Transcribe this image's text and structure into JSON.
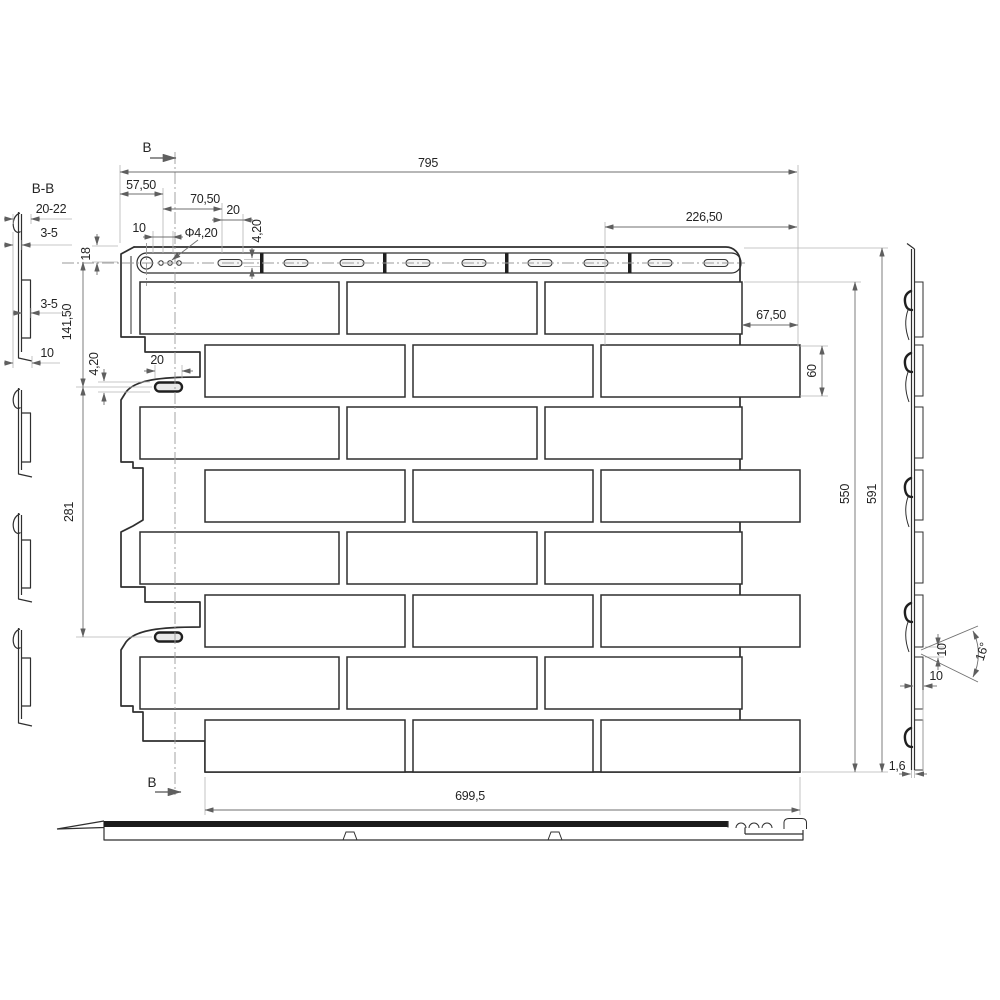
{
  "drawing": {
    "labels": {
      "section_title": "B-B",
      "cut_mark": "B"
    },
    "dims": {
      "overall_width": "795",
      "left_trim": "57,50",
      "hem_offset": "70,50",
      "slot_gap_top": "20",
      "hole_margin_top": "10",
      "hole_diameter": "Φ4,20",
      "slot_height_top": "4,20",
      "right_span": "226,50",
      "hem_height": "18",
      "first_slot_drop": "141,50",
      "left_slot_height": "4,20",
      "left_slot_width": "20",
      "slot_pitch": "281",
      "right_overhang": "67,50",
      "brick_height": "60",
      "brick_field_height": "550",
      "total_height": "591",
      "bottom_width": "699,5",
      "sheet_thickness": "1,6",
      "bump_gap": "10",
      "bump_depth": "10",
      "bump_angle": "16°",
      "section_depth_total": "20-22",
      "section_hook": "3-5",
      "section_bump": "3-5",
      "section_base": "10"
    },
    "colors": {
      "line": "#2f2f2f",
      "dimension": "#6f6f6f",
      "extension": "#b5b5b5",
      "text": "#242424",
      "edge_band": "#1b1b1b",
      "background": "#ffffff"
    }
  }
}
